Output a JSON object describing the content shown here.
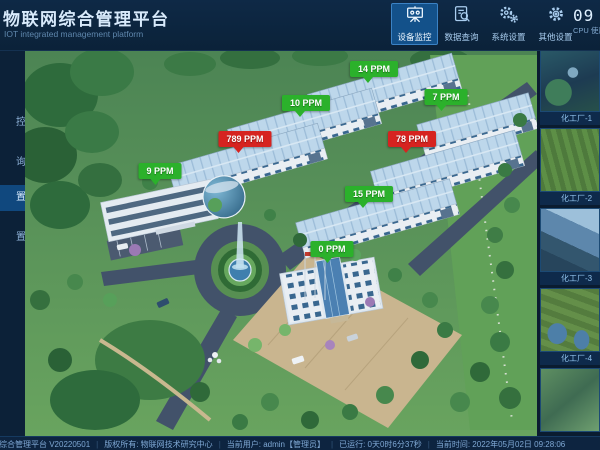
{
  "header": {
    "title": "物联网综合管理平台",
    "subtitle": "IOT integrated management platform",
    "nav": [
      {
        "label": "设备监控",
        "icon": "monitor-board-icon",
        "active": true
      },
      {
        "label": "数据查询",
        "icon": "document-search-icon",
        "active": false
      },
      {
        "label": "系统设置",
        "icon": "gears-icon",
        "active": false
      },
      {
        "label": "其他设置",
        "icon": "gear-icon",
        "active": false
      }
    ],
    "cpu_widget": {
      "digits": "09",
      "label": "CPU 使用率"
    }
  },
  "left_sidebar": {
    "items": [
      "控",
      "询",
      "置",
      "置"
    ],
    "active_index": 2
  },
  "scene": {
    "sensors": [
      {
        "value": "14 PPM",
        "status": "normal"
      },
      {
        "value": "10 PPM",
        "status": "normal"
      },
      {
        "value": "7 PPM",
        "status": "normal"
      },
      {
        "value": "789 PPM",
        "status": "alarm"
      },
      {
        "value": "78 PPM",
        "status": "alarm"
      },
      {
        "value": "9 PPM",
        "status": "normal"
      },
      {
        "value": "15 PPM",
        "status": "normal"
      },
      {
        "value": "0 PPM",
        "status": "normal"
      }
    ],
    "status_colors": {
      "normal": "#2bb12b",
      "alarm": "#d62320"
    }
  },
  "right_sidebar": {
    "thumbnails": [
      {
        "caption": "化工厂-1"
      },
      {
        "caption": "化工厂-2"
      },
      {
        "caption": "化工厂-3"
      },
      {
        "caption": "化工厂-4"
      },
      {
        "caption": ""
      }
    ]
  },
  "status_bar": {
    "separator": "|",
    "segments": [
      "综合管理平台 V20220501",
      "版权所有: 物联网技术研究中心",
      "当前用户: admin【管理员】",
      "已运行: 0天0时6分37秒",
      "当前时间: 2022年05月02日 09:28:06"
    ]
  }
}
